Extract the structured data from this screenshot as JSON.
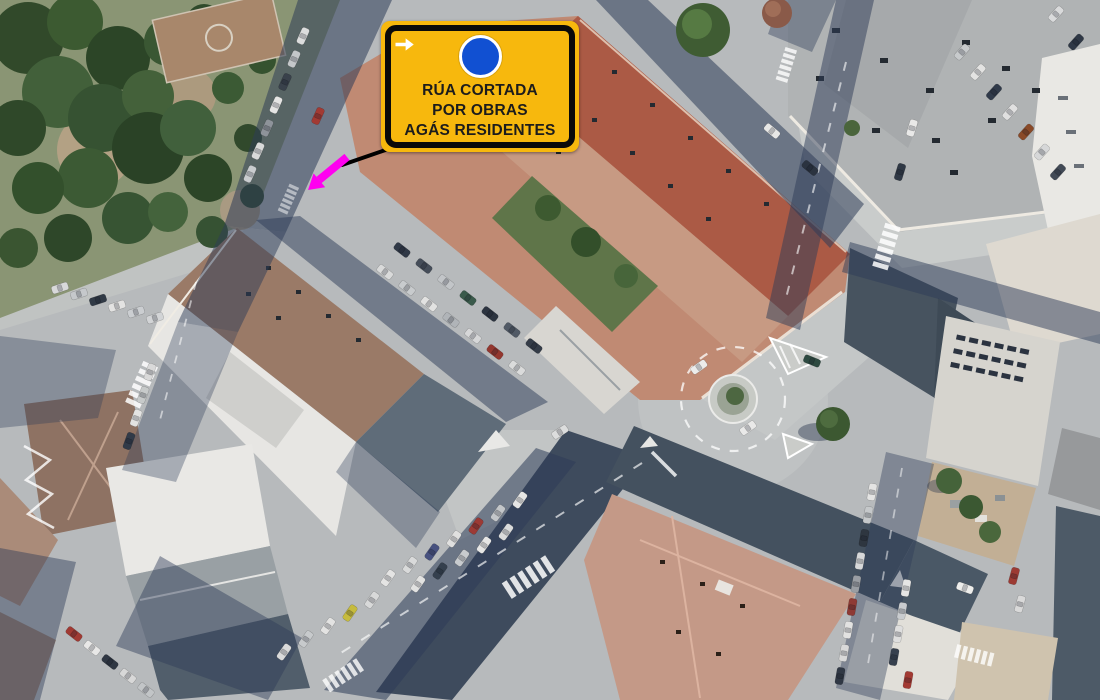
{
  "sign": {
    "lines": [
      "RÚA CORTADA",
      "POR OBRAS",
      "AGÁS RESIDENTES"
    ],
    "colors": {
      "background": "#f7b80d",
      "border": "#0a0a0a",
      "text": "#1c1c1c",
      "arrow_disc": "#1150d2",
      "arrow": "#ffffff"
    },
    "arrow_icon": "mandatory-direction-right"
  },
  "pointer": {
    "leader_color": "#000000",
    "arrow_color": "#ff00f0"
  }
}
